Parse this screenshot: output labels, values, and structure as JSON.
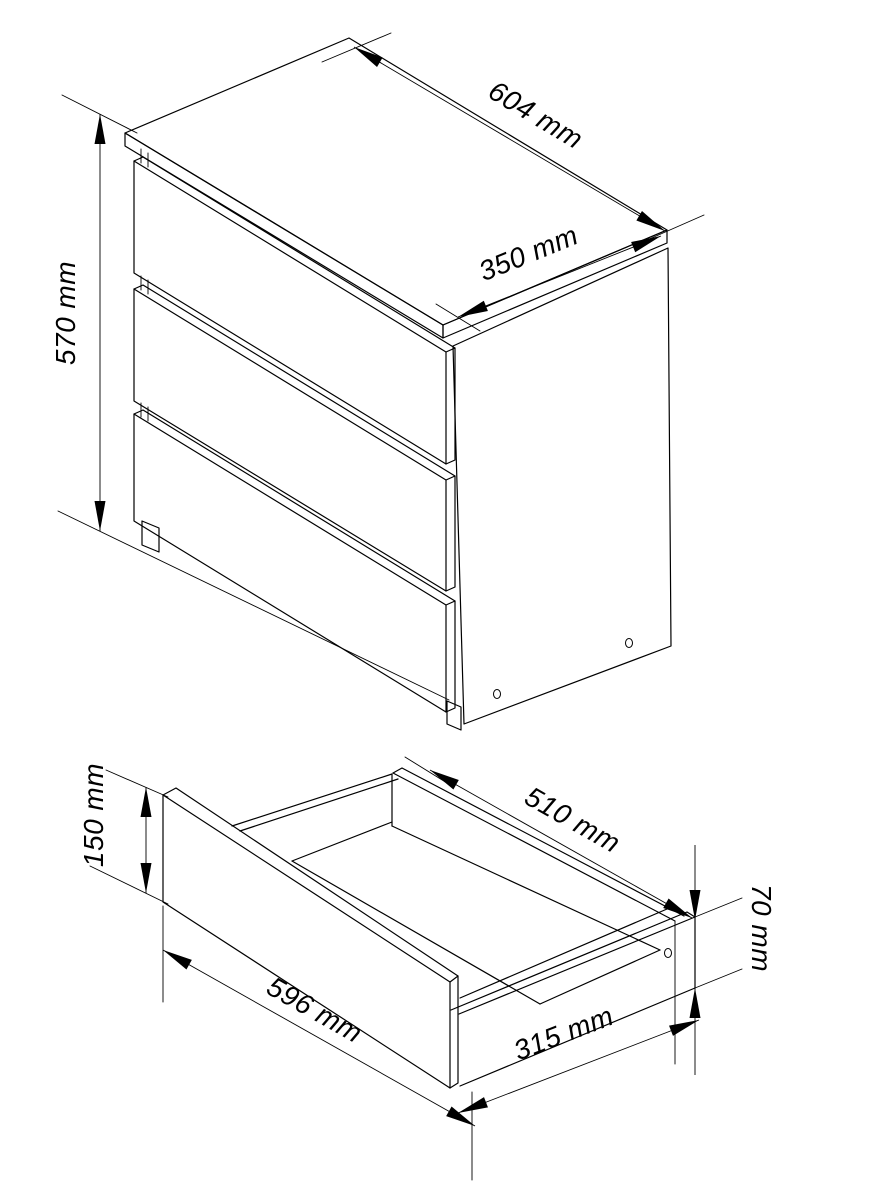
{
  "drawing": {
    "background_color": "#ffffff",
    "line_color": "#000000",
    "views": {
      "chest": {
        "description": "chest-of-drawers-isometric-view",
        "drawer_count": 3,
        "dimensions": {
          "width": "604 mm",
          "depth": "350 mm",
          "height": "570 mm"
        }
      },
      "drawer": {
        "description": "single-drawer-isometric-view",
        "dimensions": {
          "front_width": "596 mm",
          "front_height": "150 mm",
          "box_inner_width": "510 mm",
          "box_depth": "315 mm",
          "side_height": "70 mm"
        }
      }
    }
  }
}
